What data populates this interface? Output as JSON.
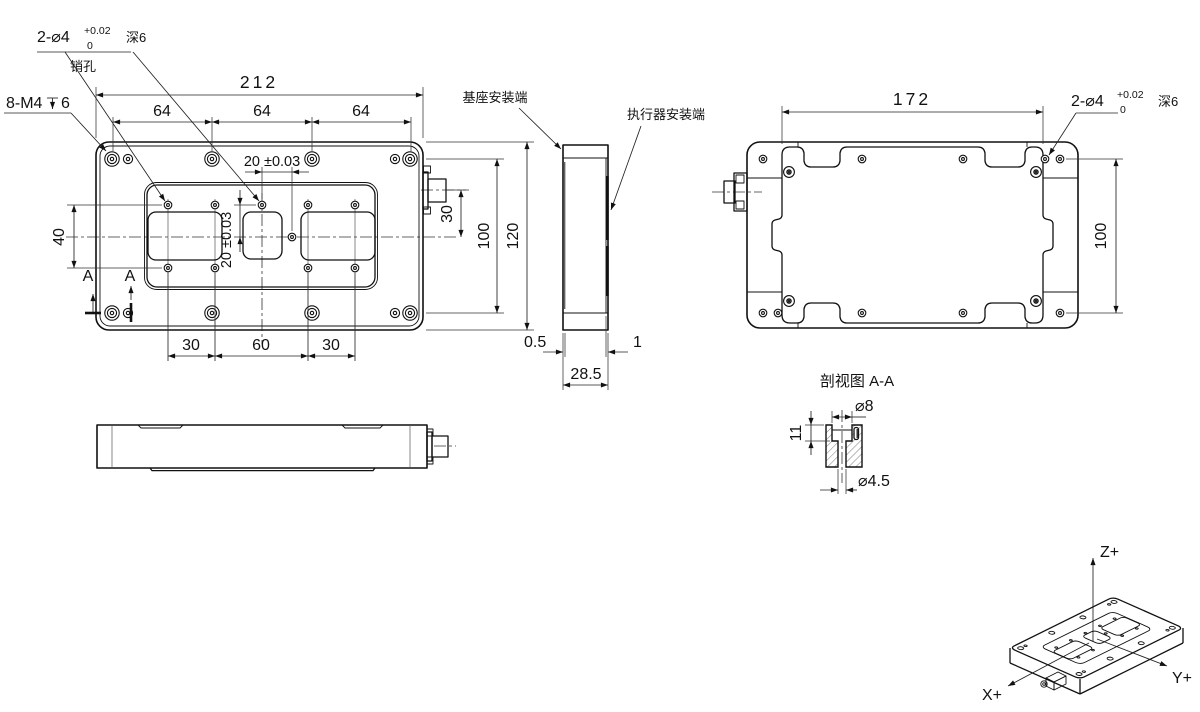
{
  "front_view": {
    "pin_callout": {
      "main": "2-⌀4",
      "tol_top": "+0.02",
      "tol_bottom": "0",
      "depth": "深6",
      "name": "销孔"
    },
    "thread_callout": {
      "main": "8-M4",
      "depth_symbol_icon": "depth-symbol",
      "depth_value": "6"
    },
    "dims": {
      "total_width": "212",
      "pitch1": "64",
      "pitch2": "64",
      "pitch3": "64",
      "pin_offset_h": "20 ±0.03",
      "pin_offset_v": "20 ±0.03",
      "pocket_span": "40",
      "bottom1": "30",
      "bottom2": "60",
      "bottom3": "30",
      "connector_offset": "30",
      "hole_rows": "100",
      "total_height": "120"
    },
    "section_marks": {
      "left": "A",
      "right": "A"
    }
  },
  "side_view": {
    "labels": {
      "base": "基座安装端",
      "actuator": "执行器安装端"
    },
    "dims": {
      "base_step": "0.5",
      "actuator_step": "1",
      "thickness": "28.5"
    }
  },
  "back_view": {
    "pin_callout": {
      "main": "2-⌀4",
      "tol_top": "+0.02",
      "tol_bottom": "0",
      "depth": "深6"
    },
    "dims": {
      "width": "172",
      "height": "100"
    }
  },
  "section_view": {
    "title": "剖视图 A-A",
    "dims": {
      "cbore_dia": "⌀8",
      "depth": "11",
      "hole_dia": "⌀4.5"
    }
  },
  "iso_view": {
    "axes": {
      "x": "X+",
      "y": "Y+",
      "z": "Z+"
    }
  }
}
